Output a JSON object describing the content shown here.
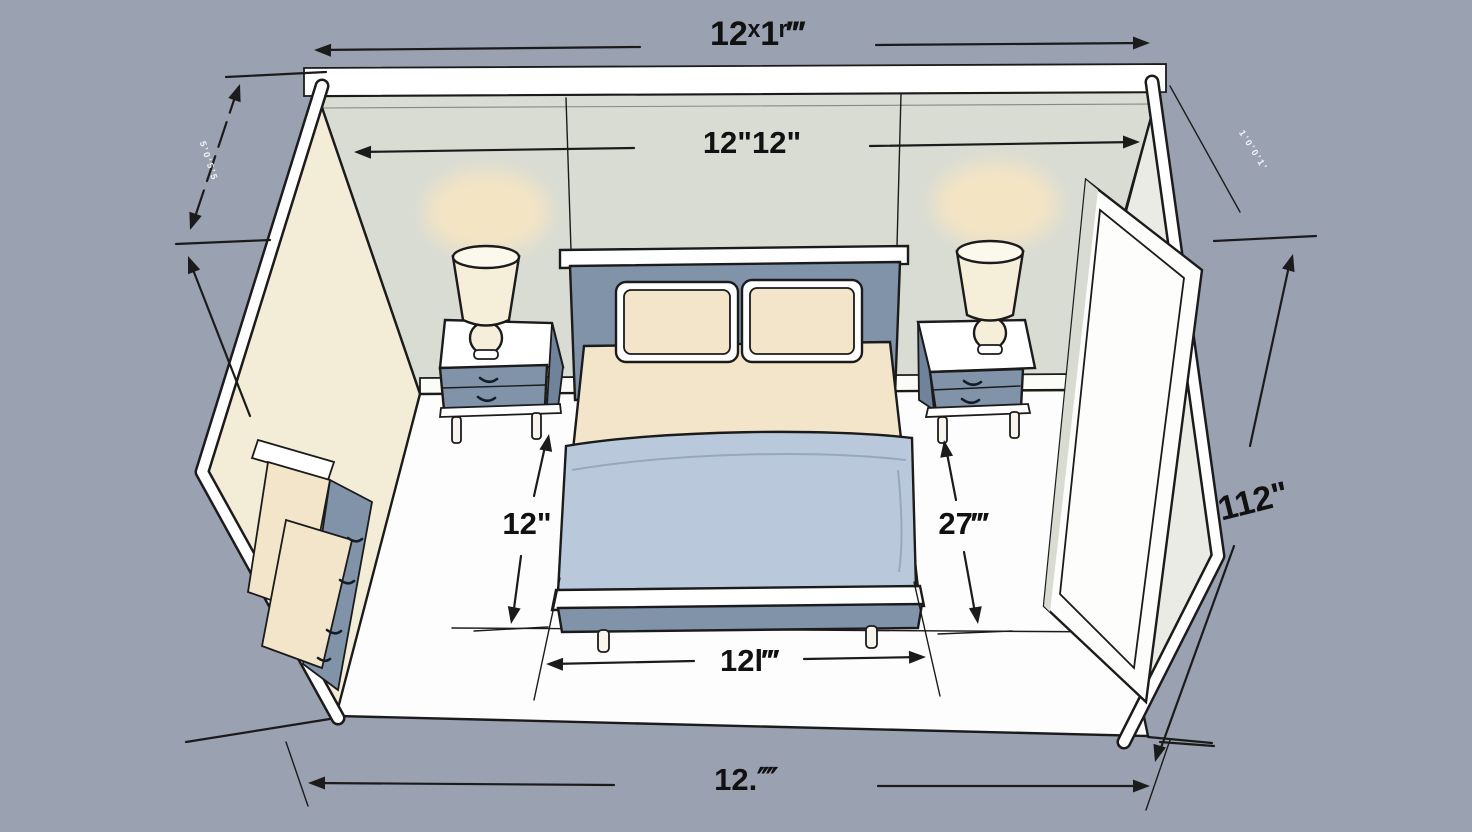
{
  "figure": {
    "type": "isometric-room-diagram",
    "subject": "Bedroom cutaway floor plan with dimension annotations"
  },
  "colors": {
    "background": "#9aa1b1",
    "back_wall": "#d9dcd3",
    "right_wall_face": "#e9ebe4",
    "side_wall_cream": "#f3ecd7",
    "floor": "#fdfdfd",
    "trim": "#ffffff",
    "furniture_slate": "#8093a9",
    "furniture_slate_dark": "#70839a",
    "blanket_blue": "#b9c9db",
    "linen_cream": "#f2e5ca",
    "lamp_shade": "#f5eed9",
    "lamp_shade_top": "#fbf8ec",
    "lamp_glow": "#f6e5c3",
    "door_white": "#fdfdfc",
    "door_jamb": "#d8dbd2",
    "line": "#1b1b1b",
    "label": "#111111"
  },
  "dimensions": {
    "top_outer": "12ˣ1ʳ‴",
    "top_inner": "12\"12\"",
    "bed_side_left": "12\"",
    "bed_side_right": "27‴",
    "bed_width": "12l‴",
    "right_wall": "112\"",
    "bottom": "12.⁗",
    "left_wall_small": "5ʼ0ʼ5ʼ5",
    "right_wall_small": "1ʼ0ʼ0ʼ1ʼ"
  }
}
